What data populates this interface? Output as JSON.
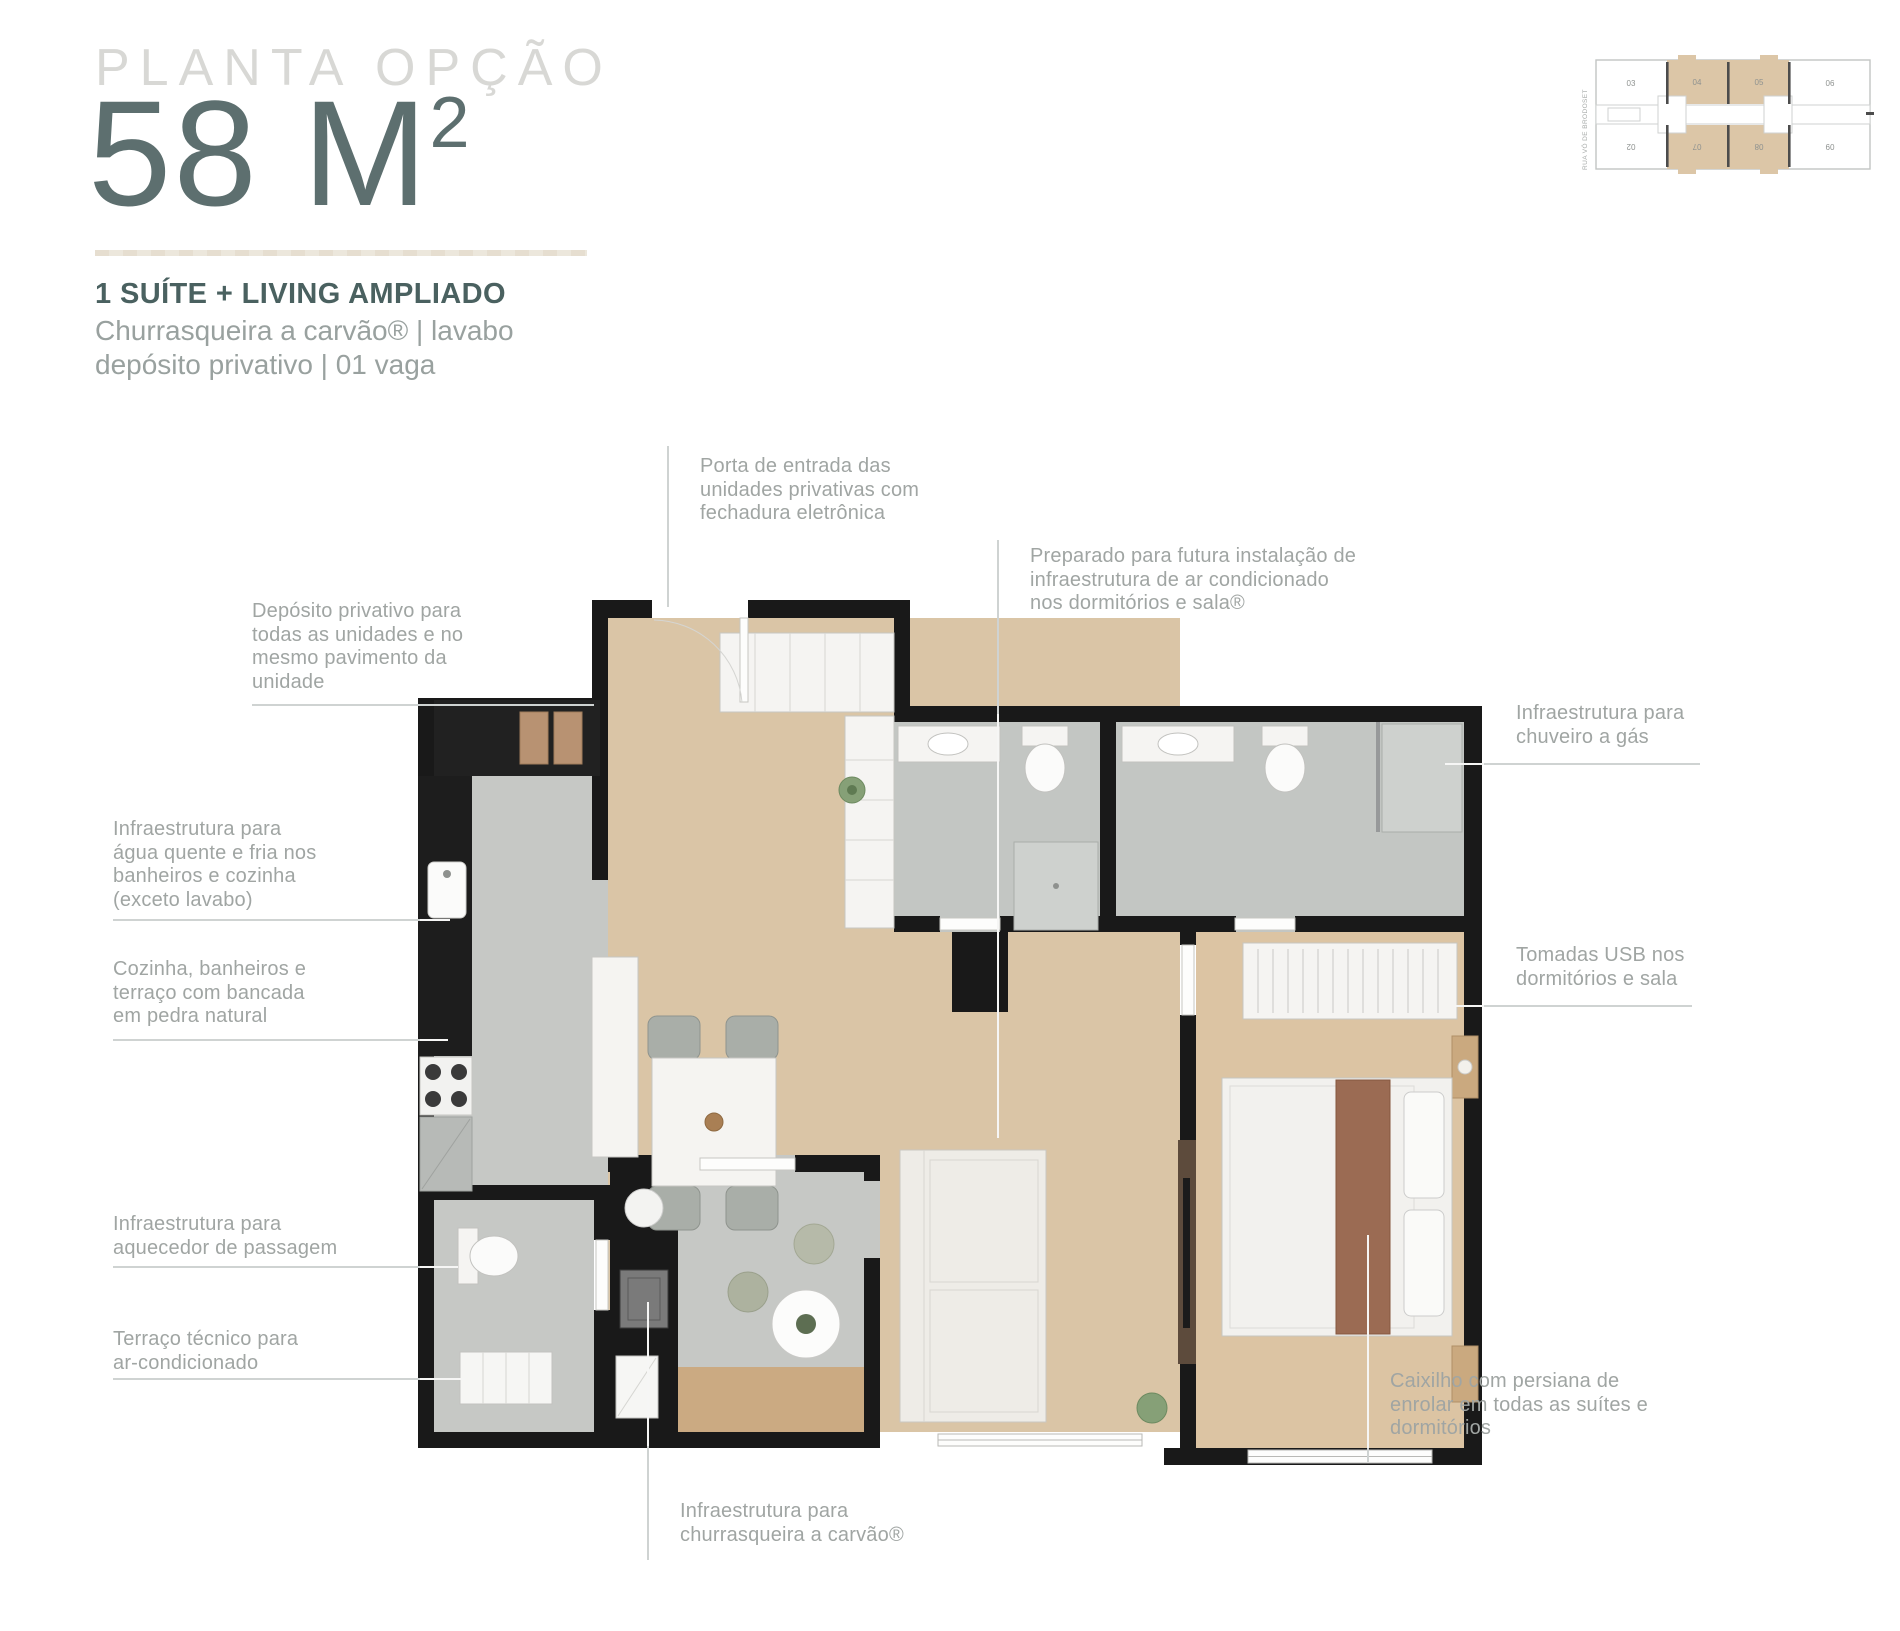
{
  "title": {
    "eyebrow": "PLANTA OPÇÃO",
    "area": "58 M",
    "area_sup": "2",
    "headline": "1 SUÍTE + LIVING AMPLIADO",
    "sub1": "Churrasqueira a carvão® | lavabo",
    "sub2": "depósito privativo | 01 vaga"
  },
  "keyplan": {
    "street_label": "RUA VÓ DE BRODOSET",
    "units_top": [
      "03",
      "04",
      "05",
      "06"
    ],
    "units_bottom": [
      "02",
      "07",
      "08",
      "09"
    ],
    "highlighted_units": [
      "04",
      "05",
      "07",
      "08"
    ],
    "highlight_color": "#dcc6a7"
  },
  "callouts": [
    {
      "id": "porta-entrada",
      "text": "Porta de entrada das\nunidades privativas com\nfechadura eletrônica"
    },
    {
      "id": "ar-condicionado",
      "text": "Preparado para futura instalação de\ninfraestrutura de ar condicionado\nnos dormitórios e sala®"
    },
    {
      "id": "deposito",
      "text": "Depósito privativo para\ntodas as unidades e no\nmesmo pavimento da\nunidade"
    },
    {
      "id": "agua-quente",
      "text": "Infraestrutura para\nágua quente e fria nos\nbanheiros e cozinha\n(exceto lavabo)"
    },
    {
      "id": "bancada-pedra",
      "text": "Cozinha, banheiros e\nterraço com bancada\nem pedra natural"
    },
    {
      "id": "aquecedor",
      "text": "Infraestrutura para\naquecedor de passagem"
    },
    {
      "id": "terraco-tecnico",
      "text": "Terraço técnico para\nar-condicionado"
    },
    {
      "id": "chuveiro-gas",
      "text": "Infraestrutura para\nchuveiro a gás"
    },
    {
      "id": "tomadas-usb",
      "text": "Tomadas USB nos\ndormitórios e sala"
    },
    {
      "id": "caixilho-persiana",
      "text": "Caixilho com persiana de\nenrolar em todas as suítes e\ndormitórios"
    },
    {
      "id": "churrasqueira",
      "text": "Infraestrutura para\nchurrasqueira a carvão®"
    }
  ],
  "colors": {
    "accent_title": "#5d6f6f",
    "eyebrow": "#d8d8d5",
    "headline": "#4a6160",
    "body_text": "#99a19f",
    "callout_text": "#a0a5a3",
    "wall": "#191919",
    "wood_floor": "#dac5a6",
    "suite_floor": "#dcc4a3",
    "wet_area_floor": "#c5c8c5",
    "terrace_band": "#cbaa82",
    "leader_on_white": "#cfd3d2",
    "leader_on_plan": "#f6f6f5"
  }
}
